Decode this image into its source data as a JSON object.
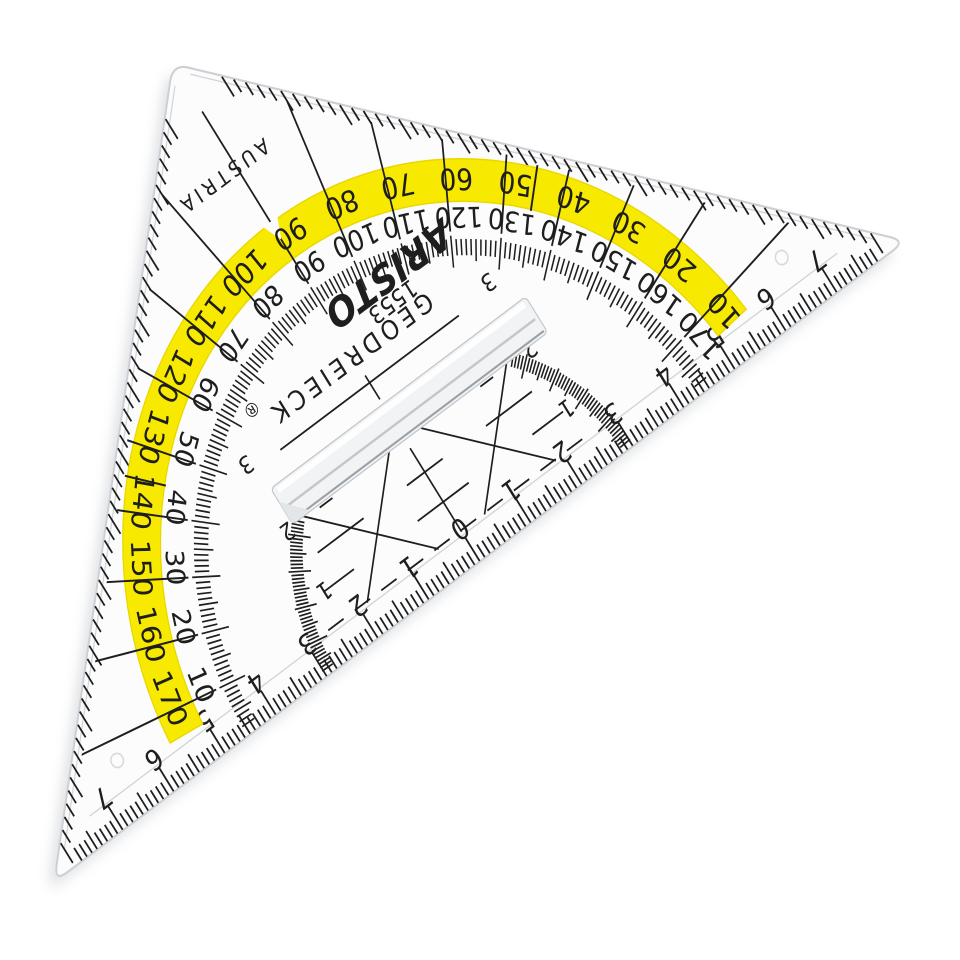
{
  "image": {
    "type": "photograph",
    "subject": "transparent protractor set square lying rotated on a white background"
  },
  "ruler": {
    "brand": "ARISTO",
    "product_name": "GEODREIECK",
    "registered_symbol": "®",
    "model_number": "1553",
    "country": "AUSTRIA",
    "protractor": {
      "outer_scale_degrees": [
        10,
        20,
        30,
        40,
        50,
        60,
        70,
        80,
        90,
        100,
        110,
        120,
        130,
        140,
        150,
        160,
        170
      ],
      "inner_scale_degrees": [
        170,
        160,
        150,
        140,
        130,
        120,
        110,
        100,
        90,
        80,
        70,
        60,
        50,
        40,
        30,
        20,
        10
      ]
    },
    "hypotenuse_scale_cm": {
      "left": [
        "7",
        "6",
        "5",
        "4",
        "3",
        "2",
        "1"
      ],
      "center": "0",
      "right": [
        "1",
        "2",
        "3",
        "4",
        "5",
        "6",
        "7"
      ]
    },
    "parallel_line_labels": [
      "1",
      "2",
      "3"
    ]
  },
  "colors": {
    "background": "#ffffff",
    "body": "#fcfcfd",
    "plastic_edge": "#ccd0d4",
    "facet_line": "#d2d6d9",
    "print": "#1e1e1e",
    "arc_band": "#f8e900",
    "arc_band_edge": "#e9d700",
    "shadow": "#7e8590",
    "grip_fill": "#f1f3f4",
    "grip_edge": "#c2c7cc",
    "grip_dark_edge": "#9ba1a8",
    "hole_ring": "#d8dbde"
  }
}
